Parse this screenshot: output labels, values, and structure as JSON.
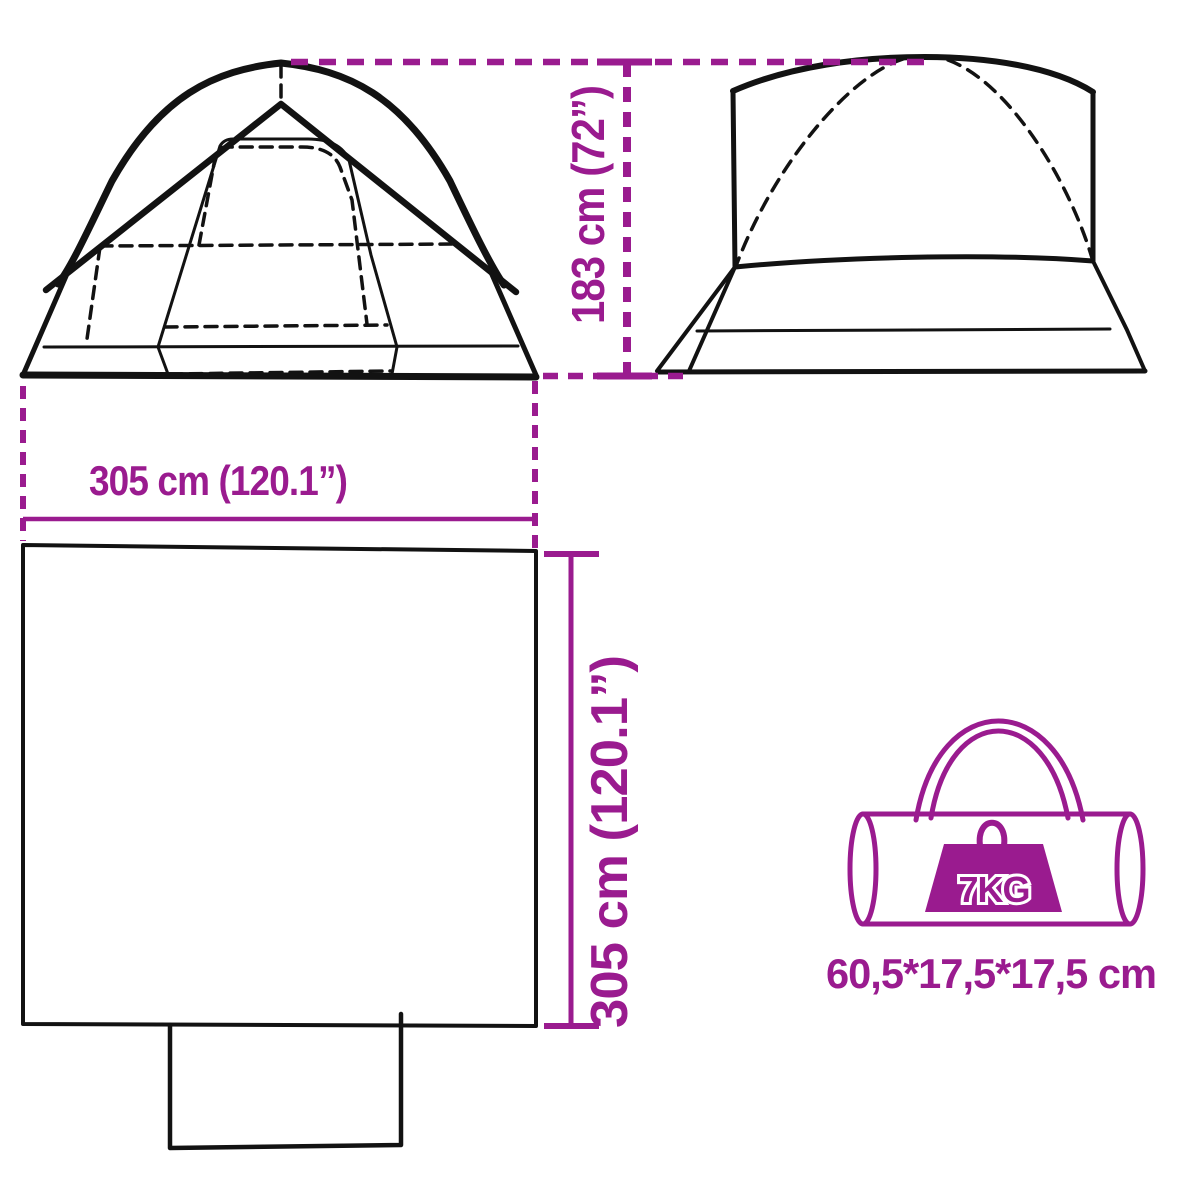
{
  "colors": {
    "accent": "#9A1B8F",
    "line": "#121212",
    "background": "#ffffff",
    "weight_text": "#ffffff"
  },
  "diagram": {
    "height_dimension": {
      "label": "183 cm (72”)"
    },
    "width_dimension": {
      "label": "305 cm (120.1”)"
    },
    "depth_dimension": {
      "label": "305 cm (120.1”)"
    },
    "bag": {
      "weight_label": "7KG",
      "size_label": "60,5*17,5*17,5 cm"
    }
  }
}
